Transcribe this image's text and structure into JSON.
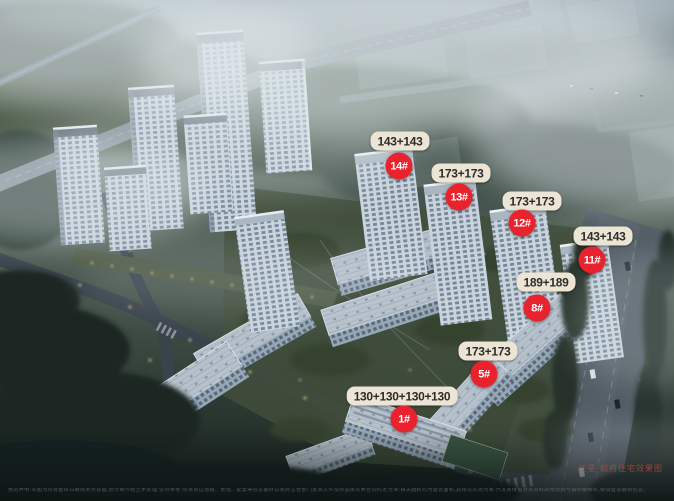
{
  "project": {
    "watermark": "红星·樾府住宅效果图"
  },
  "markers": [
    {
      "building_no": "14#",
      "unit_mix": "143+143"
    },
    {
      "building_no": "13#",
      "unit_mix": "173+173"
    },
    {
      "building_no": "12#",
      "unit_mix": "173+173"
    },
    {
      "building_no": "11#",
      "unit_mix": "143+143"
    },
    {
      "building_no": "8#",
      "unit_mix": "189+189"
    },
    {
      "building_no": "5#",
      "unit_mix": "173+173"
    },
    {
      "building_no": "1#",
      "unit_mix": "130+130+130+130"
    }
  ],
  "footer": {
    "disclaimer": "免责声明:本图为项目整体鸟瞰效果示意图,部分细节经艺术处理,仅供参考;项目周边道路、景观、配套等信息最终以政府主管部门批准文件及商品房买卖合同约定为准;相关面积均为建筑面积,具体以实测为准;开发商保留对本资料的修改权与最终解释权,敬请留意最新信息。"
  },
  "colors": {
    "marker_red": "#e8232d",
    "marker_text": "#ffffff",
    "pill_bg": "#ece5d6",
    "pill_text": "#2e2c28",
    "watermark_red": "#a64a3c"
  }
}
